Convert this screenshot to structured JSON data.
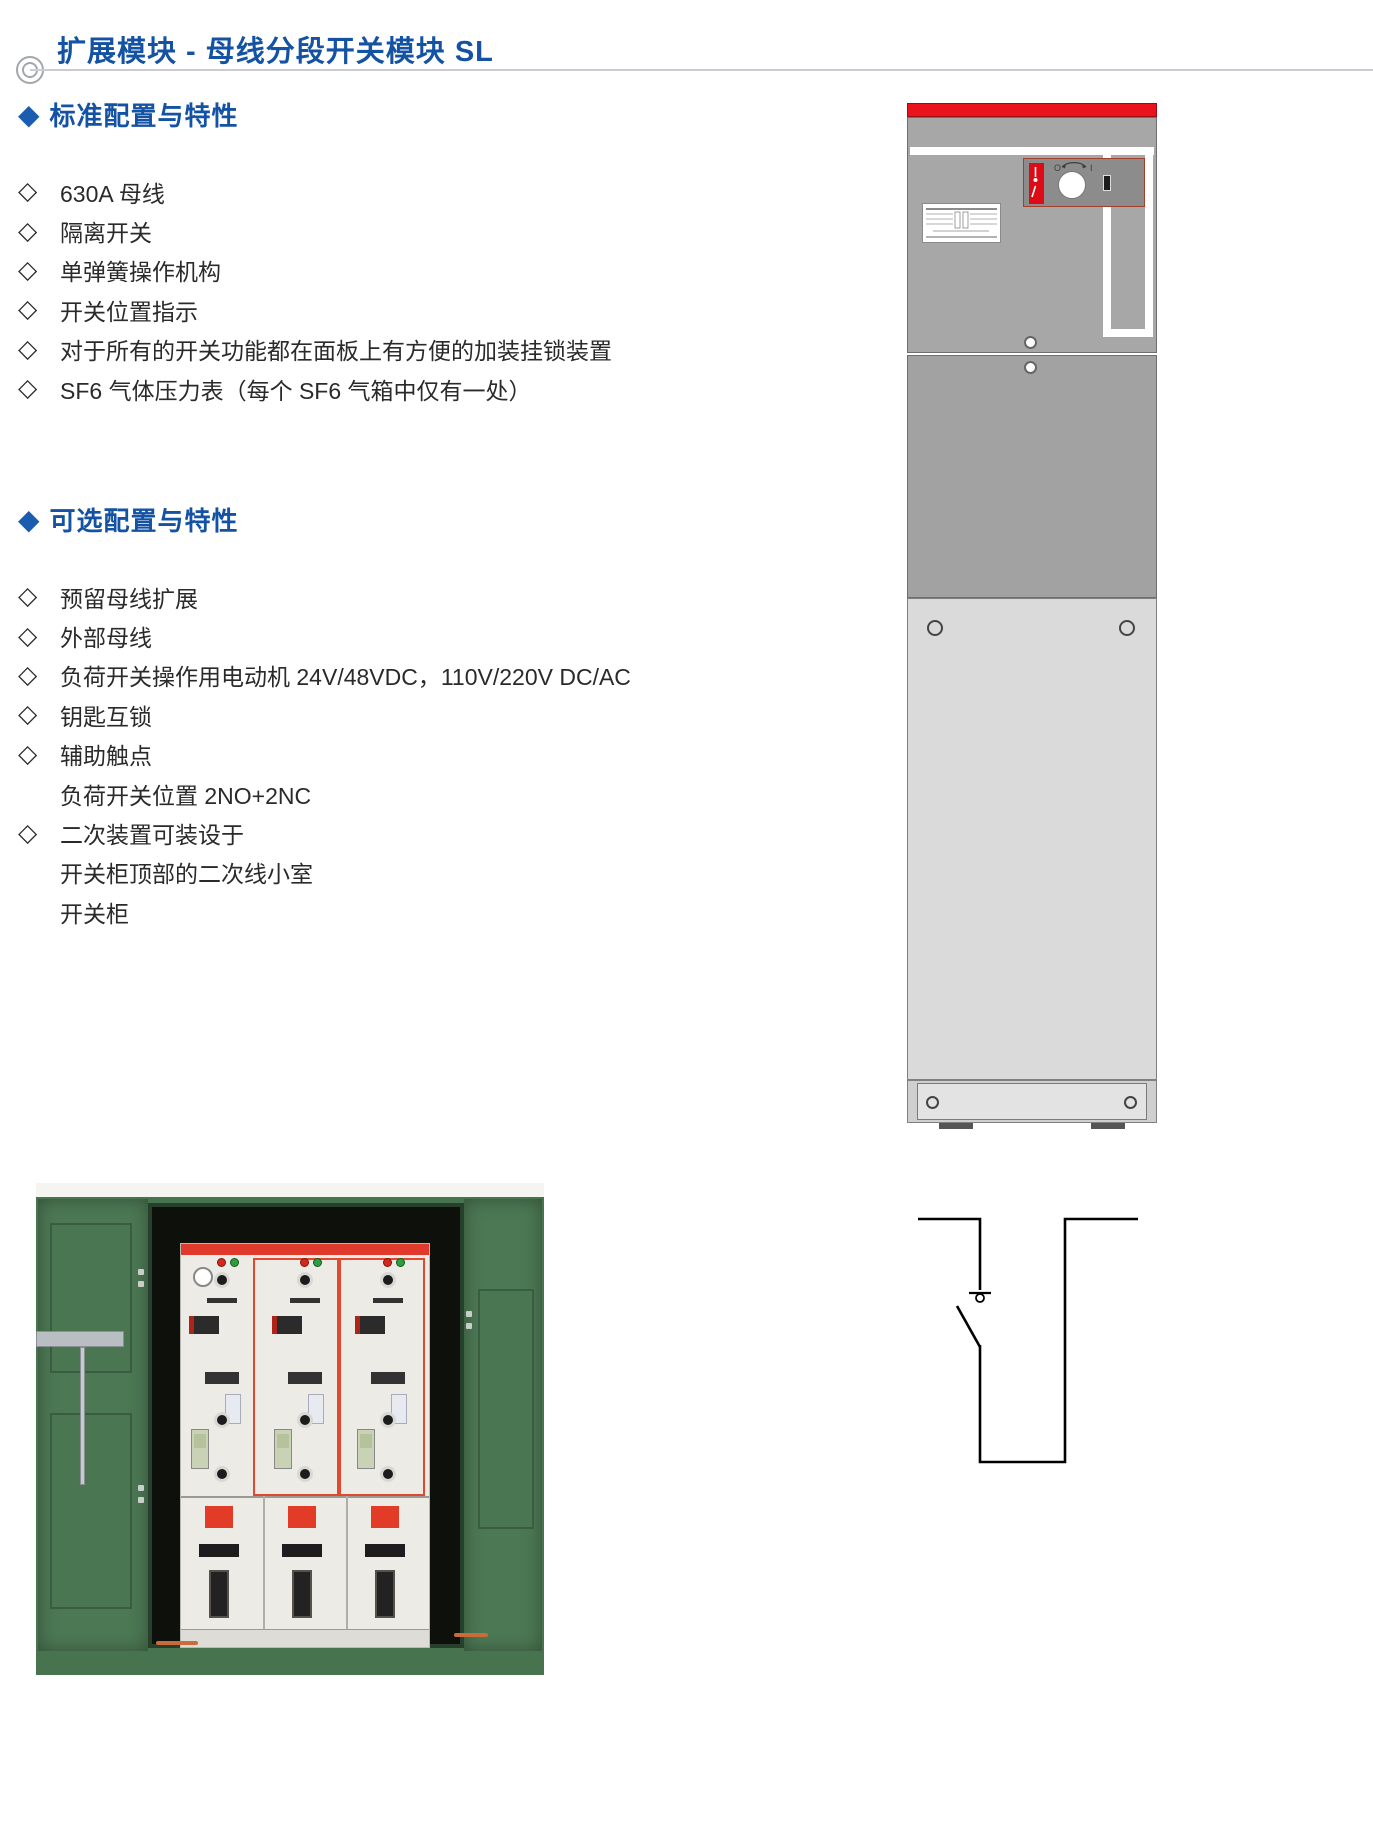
{
  "ui": {
    "section_marker": "◆",
    "item_marker": "◇"
  },
  "page": {
    "title": "扩展模块 - 母线分段开关模块 SL"
  },
  "sections": [
    {
      "heading": "标准配置与特性",
      "items": [
        {
          "text": "630A 母线"
        },
        {
          "text": "隔离开关"
        },
        {
          "text": "单弹簧操作机构"
        },
        {
          "text": "开关位置指示"
        },
        {
          "text": "对于所有的开关功能都在面板上有方便的加装挂锁装置"
        },
        {
          "text": "SF6 气体压力表（每个 SF6 气箱中仅有一处）"
        }
      ]
    },
    {
      "heading": "可选配置与特性",
      "items": [
        {
          "text": "预留母线扩展"
        },
        {
          "text": "外部母线"
        },
        {
          "text": "负荷开关操作用电动机 24V/48VDC，110V/220V DC/AC"
        },
        {
          "text": "钥匙互锁"
        },
        {
          "text": "辅助触点"
        },
        {
          "text": "负荷开关位置 2NO+2NC",
          "indent": true
        },
        {
          "text": "二次装置可装设于"
        },
        {
          "text": "开关柜顶部的二次线小室",
          "indent": true
        },
        {
          "text": "开关柜",
          "indent": true
        }
      ]
    }
  ],
  "cabinet": {
    "mimic": {
      "off_label": "O",
      "on_label": "I"
    }
  },
  "colors": {
    "accent_blue": "#1452A3",
    "cabinet_bar_red": "#E8131D",
    "mimic_red": "#DD0B16",
    "enclosure_green": "#4C7854",
    "rmu_trim_red": "#E0482F"
  }
}
